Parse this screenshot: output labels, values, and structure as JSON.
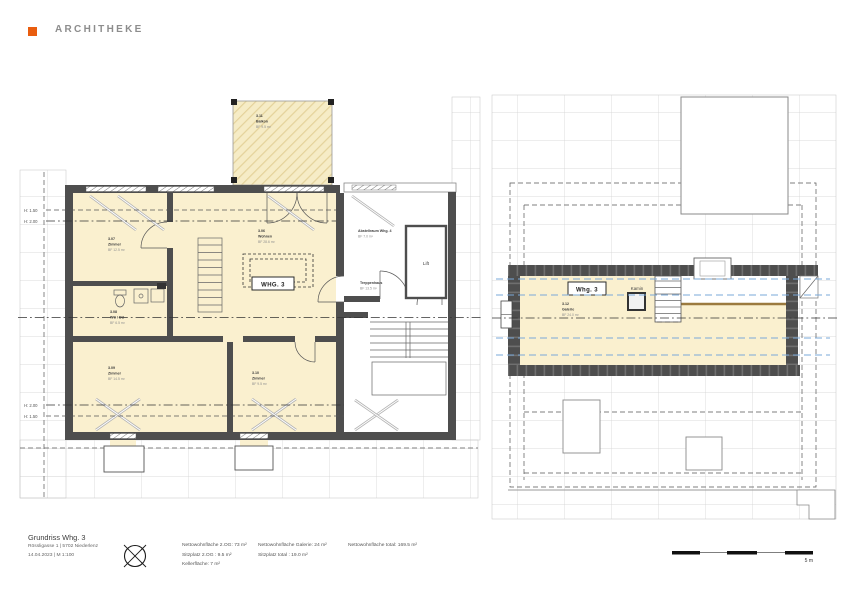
{
  "brand": {
    "name": "ARCHITHEKE",
    "accent_color": "#E95D0F"
  },
  "title_block": {
    "title": "Grundriss Whg. 3",
    "address": "Rössligasse 1 | 5702 Niederlenz",
    "date_scale": "14.04.2023    | M 1:100"
  },
  "summary": {
    "col1": [
      "Nettowohnfläche 2.OG: 73 m²",
      "Sitzplatz 2.OG : 9.5 m²",
      "Kellerfläche: 7 m²"
    ],
    "col2": [
      "Nettowohnfläche Galerie: 24 m²",
      "Sitzplatz total : 19.0 m²"
    ],
    "col3": [
      "Nettowohnfläche total: 169.5 m²"
    ]
  },
  "scale_bar": {
    "label": "5 m"
  },
  "plan_left": {
    "unit_box": "WHG. 3",
    "height_marks": {
      "top": [
        "H: 1.50",
        "H: 2.00"
      ],
      "bottom": [
        "H: 2.00",
        "H: 1.50"
      ]
    },
    "rooms": {
      "balkon": {
        "num": "3.11",
        "name": "Balkon",
        "area": "BF 9.5 m²"
      },
      "zimmer1": {
        "num": "3.07",
        "name": "Zimmer",
        "area": "BF 12.5 m²"
      },
      "wohnen": {
        "num": "3.06",
        "name": "Wohnen",
        "area": "BF 28.6 m²"
      },
      "wc": {
        "num": "3.08",
        "name": "WC / DU",
        "area": "BF 6.5 m²"
      },
      "zimmer2": {
        "num": "3.09",
        "name": "Zimmer",
        "area": "BF 14.5 m²"
      },
      "zimmer3": {
        "num": "3.10",
        "name": "Zimmer",
        "area": "BF 9.5 m²"
      },
      "abstellraum": {
        "name": "Abstellraum Whg. 4",
        "area": "BF 7.0 m²"
      },
      "lift": {
        "name": "Lift"
      },
      "treppenhaus": {
        "name": "Treppenhaus",
        "area": "BF 13.5 m²"
      }
    }
  },
  "plan_right": {
    "unit_box": "Whg. 3",
    "kamin_label": "Kamin",
    "galerie": {
      "num": "3.12",
      "name": "Galerie",
      "area": "BF 24.0 m²"
    }
  },
  "colors": {
    "room_fill": "#FAF0CF",
    "wall": "#4E4E4E",
    "roof_grid": "#D0D0D0",
    "height_line_blue": "#7AA8D8",
    "wood_rail": "#9B7A3F"
  }
}
